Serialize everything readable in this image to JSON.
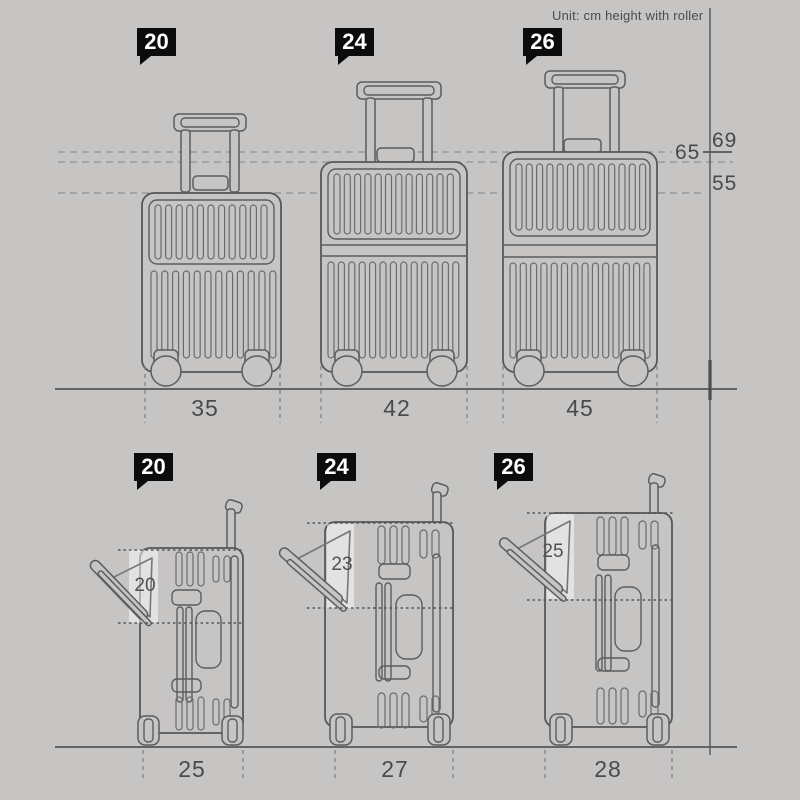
{
  "background": "#c7c5c3",
  "ink": "#5c5d5f",
  "tag_black": "#0c0c0c",
  "highlight_white": "rgba(255,255,255,0.5)",
  "unit_note": "Unit: cm height with roller",
  "front_view": {
    "size_tags": [
      "20",
      "24",
      "26"
    ],
    "height_labels": [
      "69",
      "65",
      "55"
    ],
    "width_labels": [
      "35",
      "42",
      "45"
    ]
  },
  "side_view": {
    "size_tags": [
      "20",
      "24",
      "26"
    ],
    "opening_labels": [
      "20",
      "23",
      "25"
    ],
    "depth_labels": [
      "25",
      "27",
      "28"
    ]
  },
  "sizes": [
    {
      "tag": "20",
      "width_cm": "35",
      "height_cm": "55",
      "opening_cm": "20",
      "depth_cm": "25"
    },
    {
      "tag": "24",
      "width_cm": "42",
      "height_cm": "65",
      "opening_cm": "23",
      "depth_cm": "27"
    },
    {
      "tag": "26",
      "width_cm": "45",
      "height_cm": "69",
      "opening_cm": "25",
      "depth_cm": "28"
    }
  ]
}
